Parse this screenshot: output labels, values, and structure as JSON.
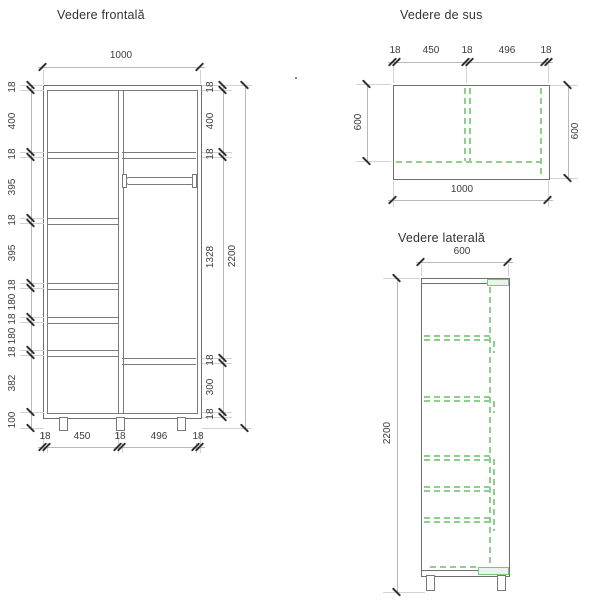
{
  "front": {
    "title": "Vedere frontală",
    "width_total": "1000",
    "height_total": "2200",
    "left_chain": [
      "18",
      "400",
      "18",
      "395",
      "18",
      "395",
      "18",
      "180",
      "18",
      "180",
      "18",
      "382",
      "100"
    ],
    "right_chain": [
      "18",
      "400",
      "18",
      "1328",
      "18",
      "300",
      "18"
    ],
    "bottom_chain": [
      "18",
      "450",
      "18",
      "496",
      "18"
    ]
  },
  "top_view": {
    "title": "Vedere de sus",
    "top_chain": [
      "18",
      "450",
      "18",
      "496",
      "18"
    ],
    "left_depth": "600",
    "right_depth": "600",
    "bottom_width": "1000"
  },
  "side_view": {
    "title": "Vedere laterală",
    "top_depth": "600",
    "left_height": "2200"
  },
  "colors": {
    "outline": "#6f6f6f",
    "hidden_edge_green": "#8ecf8e",
    "tick": "#2e2e2e",
    "dimension_line": "#b9b9b9",
    "text": "#3c3c3c"
  }
}
